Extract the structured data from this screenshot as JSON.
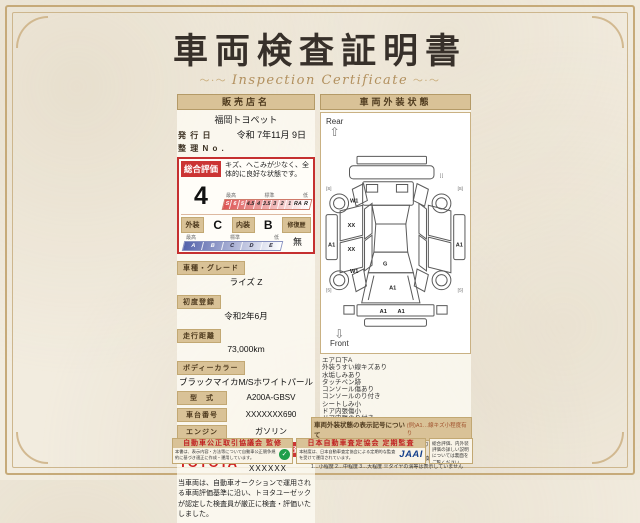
{
  "page": {
    "title": "車両検査証明書",
    "subtitle": "Inspection Certificate"
  },
  "colors": {
    "accent_red": "#c53030",
    "tan_header": "#d9c297",
    "toyota_red": "#d02020",
    "jaai_blue": "#16418c",
    "emblem_green": "#1f9e4b"
  },
  "left": {
    "dealer_header": "販売店名",
    "dealer_name": "福岡トヨペット",
    "issue_label": "発 行 日",
    "issue_value": "令和 7年11月 9日",
    "ref_label": "整 理 N o .",
    "ref_value": "",
    "rating": {
      "header": "総合評価",
      "value": "4",
      "comment": "キズ、へこみが少なく、全体的に良好な状態です。",
      "scale_best": "最高",
      "scale_mid": "標準",
      "scale_low": "低",
      "cells": [
        "S",
        "6",
        "5",
        "4.5",
        "4",
        "3.5",
        "3",
        "2",
        "1",
        "RA",
        "R"
      ],
      "exterior_label": "外装",
      "exterior_value": "C",
      "interior_label": "内装",
      "interior_value": "B",
      "repair_label": "修復歴",
      "repair_value": "無",
      "grade_best": "最高",
      "grade_mid": "標準",
      "grade_low": "低",
      "grade_cells": [
        "A",
        "B",
        "C",
        "D",
        "E"
      ]
    },
    "fields": [
      {
        "label": "車種・グレード",
        "value": "ライズ Z"
      },
      {
        "label": "初度登録",
        "value": "令和2年6月"
      },
      {
        "label": "走行距離",
        "value": "73,000km"
      },
      {
        "label": "ボディーカラー",
        "value": "ブラックマイカM/Sホワイトパール"
      },
      {
        "label": "型　式",
        "value": "A200A-GBSV"
      },
      {
        "label": "車台番号",
        "value": "XXXXXXX690"
      },
      {
        "label": "エンジン",
        "value": "ガソリン"
      }
    ],
    "toyota_logo": "TOYOTA",
    "inspector_badge": "トヨタ認定車両検査員",
    "inspector_name": "XXXXXX",
    "disclaimer": "当車両は、自動車オークションで運用される車両評価基準に沿い、トヨタユーゼックが認定した検査員が厳正に検査・評価いたしました。"
  },
  "right": {
    "header": "車両外装状態",
    "rear_label": "Rear",
    "front_label": "Front",
    "markers": {
      "rear_w1": "W1",
      "front_w1": "W1",
      "door_xx_upper": "XX",
      "door_xx_lower": "XX",
      "left_a1": "A1",
      "right_a1": "A1",
      "glass_g": "G",
      "hood_a1": "A1",
      "bumper_a1_left": "A1",
      "bumper_a1_right": "A1",
      "bracket_top_right": "[ ]",
      "bracket_rear_left": "[S]",
      "bracket_rear_right": "[S]",
      "bracket_front_left": "[S]",
      "bracket_front_right": "[S]"
    },
    "notes": [
      "エアロ下A",
      "外装うすい線キズあり",
      "水垢しみあり",
      "タッチペン跡",
      "コンソール傷あり",
      "コンソールのり付き",
      "シートしみ小",
      "ドア内張傷小",
      "ドア内張のり付き",
      "ピラー内張ビス穴あり"
    ],
    "legend_title": "車両外装状態の表示記号について",
    "legend_example": "(例)A1…線キズ小程度有り",
    "legend_lines": [
      "A…線キズあり U…へこみあり B…キズ・へこみあり P…塗装傷あり W…補修跡あり S…サビあり",
      "C…腐食あり G…フロントガラスキズあり X…要交換 XX…交換歴あり",
      "1…小程度 2…中程度 3…大程度 ※タイヤの溝等は表示していません"
    ]
  },
  "footer": {
    "fair_trade": {
      "title": "自動車公正取引協議会 監修",
      "text": "本書は、表示内容・方法等について自動車公正競争規約に基づき適正に作成・運用しています。"
    },
    "jaai": {
      "title": "日本自動車査定協会 定期監査",
      "text": "本制度は、日本自動車査定協会による定期的な監査を受けて運用されています。",
      "logo": "JAAI"
    },
    "back_note": "総合評価、内外装評価の詳しい説明については裏面をご覧ください。"
  }
}
